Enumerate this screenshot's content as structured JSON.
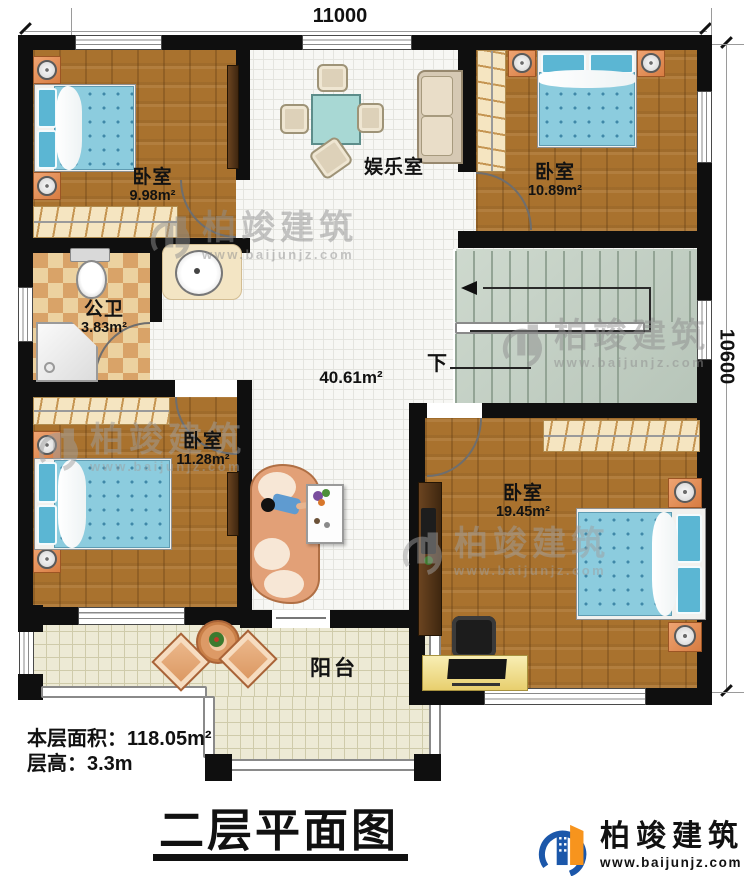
{
  "dimensions": {
    "width_top": "11000",
    "height_right": "10600"
  },
  "rooms": {
    "bedroom_tl": {
      "name": "卧室",
      "area": "9.98m²"
    },
    "bedroom_tr": {
      "name": "卧室",
      "area": "10.89m²"
    },
    "bedroom_bl": {
      "name": "卧室",
      "area": "11.28m²"
    },
    "bedroom_br": {
      "name": "卧室",
      "area": "19.45m²"
    },
    "bathroom": {
      "name": "公卫",
      "area": "3.83m²"
    },
    "entertainment": {
      "name": "娱乐室"
    },
    "hall": {
      "area": "40.61m²"
    },
    "stairs": {
      "down_label": "下"
    },
    "balcony": {
      "name": "阳台"
    }
  },
  "info": {
    "line1": "本层面积：118.05m²",
    "line2": "层高：3.3m"
  },
  "title": "二层平面图",
  "brand": {
    "name": "柏竣建筑",
    "url": "www.baijunjz.com"
  },
  "watermark": {
    "name": "柏竣建筑",
    "url": "www.baijunjz.com"
  },
  "colors": {
    "wall": "#0f0f0f",
    "wood": "#a9722e",
    "tile": "#f7f7f4",
    "bath_tile": "#d9a368",
    "balcony_tile": "#edead5",
    "stairs": "#c3cfc3",
    "bed": "#8ccfe0",
    "brand_blue": "#1b57aa",
    "brand_orange": "#f7941d"
  }
}
